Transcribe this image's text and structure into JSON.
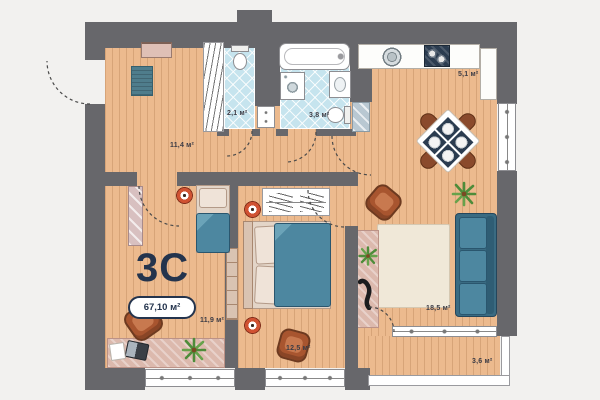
{
  "plan_type": "apartment-floor-plan",
  "unit": {
    "label": "3C",
    "total_area": "67,10 м²"
  },
  "rooms": [
    {
      "id": "hallway",
      "area": "11,4 м²"
    },
    {
      "id": "wc",
      "area": "2,1 м²"
    },
    {
      "id": "bathroom",
      "area": "3,8 м²"
    },
    {
      "id": "kitchen",
      "area": "5,1 м²"
    },
    {
      "id": "living-room",
      "area": "18,5 м²"
    },
    {
      "id": "bedroom-1",
      "area": "11,9 м²"
    },
    {
      "id": "bedroom-2",
      "area": "12,5 м²"
    },
    {
      "id": "balcony",
      "area": "3,6 м²"
    }
  ],
  "colors": {
    "wall": "#67676b",
    "floor": "#ecba8e",
    "tile": "#c6e4ee",
    "teal": "#4d87a0",
    "accent": "#24344d",
    "wood": "#a8552f",
    "lamp": "#d05232",
    "glass": "#b9c8d2",
    "rug": "#f0e8d8",
    "runner": "#dcb9ad"
  }
}
